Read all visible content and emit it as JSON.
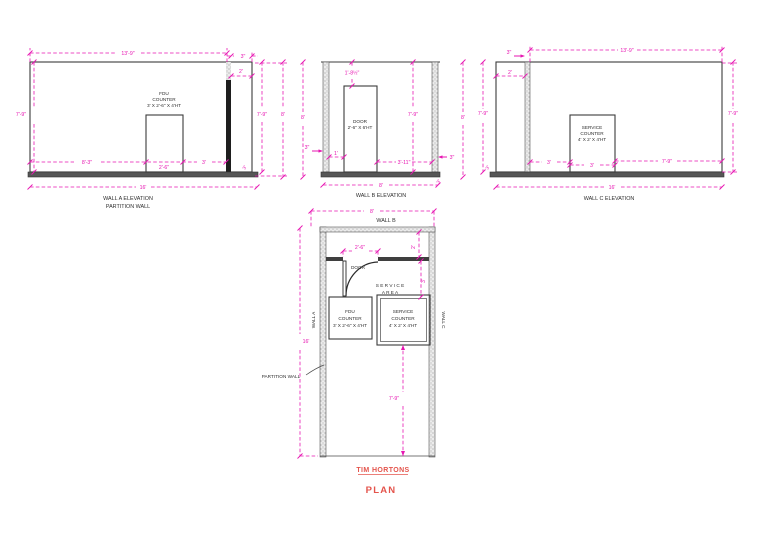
{
  "colors": {
    "dimension": "#e716b2",
    "line": "#3b3b3b",
    "title_red": "#e4544c"
  },
  "elev_a": {
    "title": "WALL A ELEVATION",
    "subtitle": "PARTITION WALL",
    "counter": [
      "FDU",
      "COUNTER",
      "3' X 2'-6\" X 4'HT"
    ],
    "dims": {
      "width_top": "13'-9\"",
      "partition": "3\"",
      "offset": "2'",
      "height_left": "7'-9\"",
      "height_right": "7'-9\"",
      "height_overall": "8'",
      "seg_left": "8'-3\"",
      "seg_counter": "2'-6\"",
      "seg_right": "3'",
      "width_overall": "16'",
      "base": "3\""
    }
  },
  "elev_b": {
    "title": "WALL B ELEVATION",
    "door": [
      "DOOR",
      "2'-6\" X 6'HT"
    ],
    "dims": {
      "head": "1'-8½\"",
      "height_left": "8'",
      "height_right": "7'-9\"",
      "wall_left": "3\"",
      "seg_left": "1'",
      "seg_right": "3'-11\"",
      "wall_right": "3\"",
      "width": "8'",
      "base": "3\""
    }
  },
  "elev_c": {
    "title": "WALL C ELEVATION",
    "counter": [
      "SERVICE",
      "COUNTER",
      "4' X 2' X 4'HT"
    ],
    "dims": {
      "width_top": "13'-9\"",
      "partition": "3\"",
      "offset": "2'",
      "height_outer": "8'",
      "height_left": "7'-9\"",
      "height_right": "7'-9\"",
      "seg_a": "3'",
      "seg_b": "3'",
      "seg_c": "7'-9\"",
      "width_overall": "16'",
      "base": "3\""
    }
  },
  "plan": {
    "wall_a": "WALL A",
    "wall_b": "WALL B",
    "wall_c": "WALL C",
    "door_label": "DOOR",
    "service_area": [
      "S E R V I C E",
      "A R E A"
    ],
    "fdu_counter": [
      "FDU",
      "COUNTER",
      "3' X 2'-6\" X 4'HT"
    ],
    "service_counter": [
      "SERVICE",
      "COUNTER",
      "4' X 2' X 4'HT"
    ],
    "partition_label": "PARTITION WALL",
    "dims": {
      "width": "8'",
      "door": "2'-6\"",
      "offset": "2'",
      "service_depth": "3'",
      "length": "16'",
      "clear": "7'-9\""
    }
  },
  "titleblock": {
    "project": "TIM HORTONS",
    "sheet": "PLAN"
  }
}
